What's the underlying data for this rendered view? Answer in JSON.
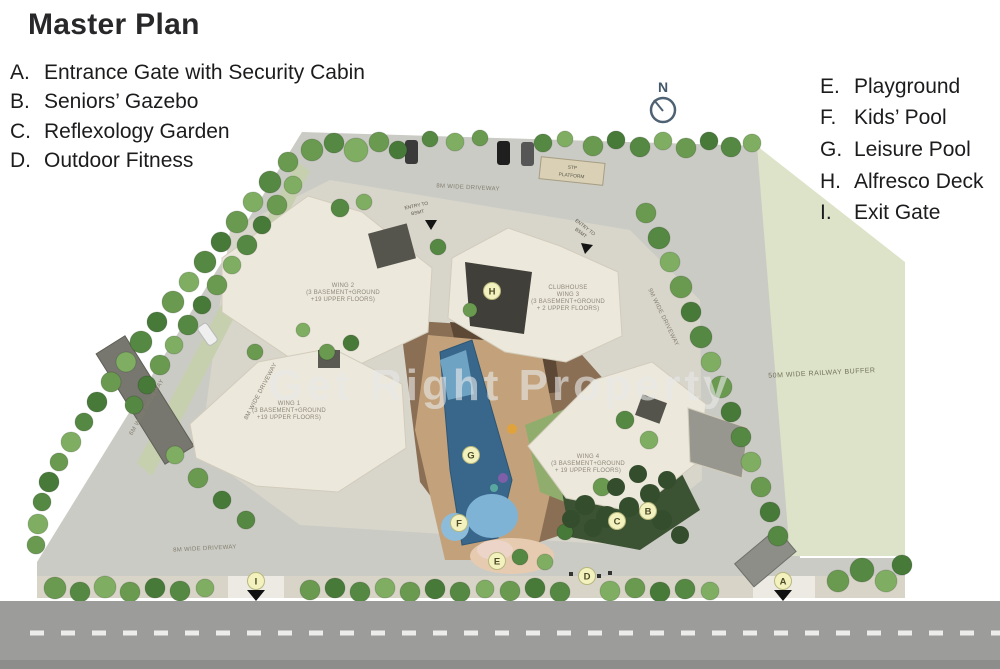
{
  "title": "Master Plan",
  "compass": {
    "label": "N"
  },
  "watermark": "Get Right Property",
  "legend_left": [
    {
      "key": "A.",
      "label": "Entrance Gate with Security Cabin"
    },
    {
      "key": "B.",
      "label": "Seniors’ Gazebo"
    },
    {
      "key": "C.",
      "label": "Reflexology Garden"
    },
    {
      "key": "D.",
      "label": "Outdoor Fitness"
    }
  ],
  "legend_right": [
    {
      "key": "E.",
      "label": "Playground"
    },
    {
      "key": "F.",
      "label": "Kids’ Pool"
    },
    {
      "key": "G.",
      "label": "Leisure Pool"
    },
    {
      "key": "H.",
      "label": "Alfresco Deck"
    },
    {
      "key": "I.",
      "label": "Exit Gate"
    }
  ],
  "plan": {
    "buildings": [
      {
        "id": "wing-2",
        "lines": [
          "WING 2",
          "(3 BASEMENT+GROUND",
          "+19 UPPER FLOORS)"
        ]
      },
      {
        "id": "clubhouse-wing-3",
        "lines": [
          "CLUBHOUSE",
          "WING 3",
          "(3 BASEMENT+GROUND",
          "+ 2 UPPER FLOORS)"
        ]
      },
      {
        "id": "wing-1",
        "lines": [
          "WING 1",
          "(3 BASEMENT+GROUND",
          "+19 UPPER FLOORS)"
        ]
      },
      {
        "id": "wing-4",
        "lines": [
          "WING 4",
          "(3 BASEMENT+GROUND",
          "+ 19 UPPER FLOORS)"
        ]
      }
    ],
    "labels": {
      "driveway_top": "8M WIDE DRIVEWAY",
      "driveway_left_inner": "8M WIDE DRIVEWAY",
      "driveway_left_outer": "6M WIDE DRIVEWAY",
      "driveway_bottom": "8M WIDE DRIVEWAY",
      "driveway_right": "9M WIDE DRIVEWAY",
      "railway_buffer": "50M WIDE RAILWAY BUFFER",
      "stp_line1": "STP",
      "stp_line2": "PLATFORM",
      "entry_line1": "ENTRY TO",
      "entry_line2": "BSMT"
    },
    "markers": [
      {
        "letter": "A"
      },
      {
        "letter": "B"
      },
      {
        "letter": "C"
      },
      {
        "letter": "D"
      },
      {
        "letter": "E"
      },
      {
        "letter": "F"
      },
      {
        "letter": "G"
      },
      {
        "letter": "H"
      },
      {
        "letter": "I"
      }
    ]
  },
  "colors": {
    "site_gray": "#cbcbc5",
    "buffer_green": "#dde3c8",
    "building_cream": "#ece8dc",
    "pool_dark": "#38678b",
    "pool_light": "#7fb3d6",
    "deck_tan": "#c3a27b",
    "lawn_green": "#90ad6d",
    "road_gray": "#9c9c9a",
    "marker_fill": "#f3f1bd"
  }
}
